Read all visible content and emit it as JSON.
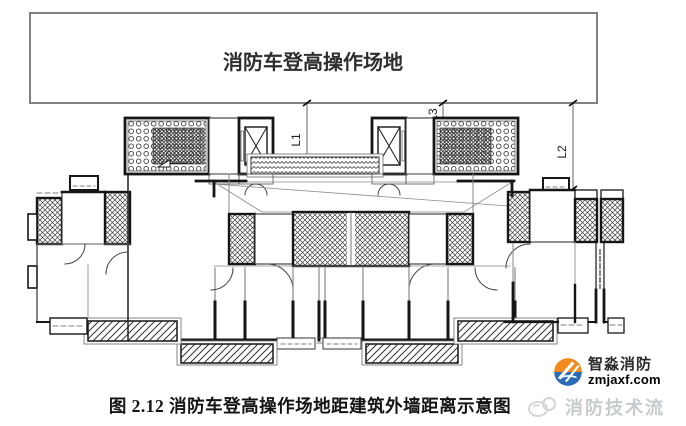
{
  "figure": {
    "site_label": "消防车登高操作场地",
    "dimensions": {
      "l1": "L1",
      "l2": "L2",
      "l3": "L3"
    },
    "caption": "图 2.12 消防车登高操作场地距建筑外墙距离示意图"
  },
  "branding": {
    "logo_title": "智淼消防",
    "logo_url": "zmjaxf.com",
    "watermark": "消防技术流",
    "colors": {
      "logo_orange": "#f28a1d",
      "logo_blue": "#2b6cb8",
      "watermark_gray": "#c6cbce"
    }
  },
  "colors": {
    "wall": "#1a1a1a",
    "dim_line": "#666666",
    "site_border": "#828282"
  }
}
